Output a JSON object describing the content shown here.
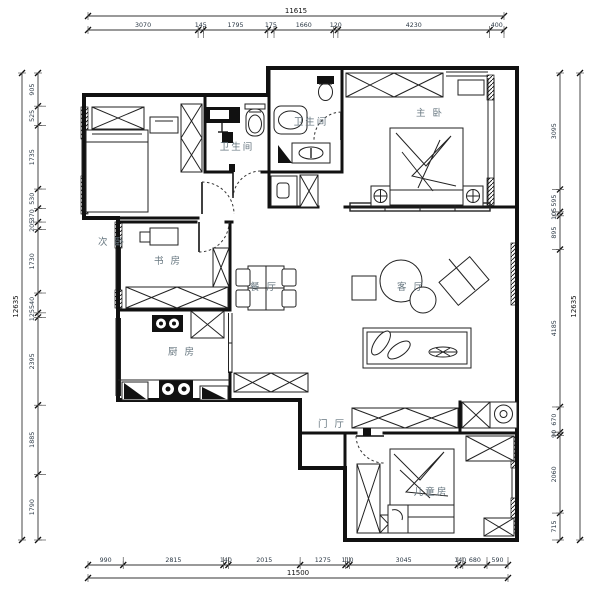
{
  "drawing_title": "apartment-floor-plan",
  "colors": {
    "wall": "#111111",
    "room_label": "#66767f",
    "dimension_text": "#2a3744",
    "background": "#ffffff"
  },
  "rooms": [
    {
      "id": "secondary-bedroom",
      "name": "次 卧",
      "x": 112,
      "y": 245
    },
    {
      "id": "bathroom-left",
      "name": "卫生间",
      "x": 237,
      "y": 150
    },
    {
      "id": "bathroom-master",
      "name": "卫生间",
      "x": 311,
      "y": 125
    },
    {
      "id": "master-bedroom",
      "name": "主 卧",
      "x": 430,
      "y": 116
    },
    {
      "id": "study",
      "name": "书 房",
      "x": 168,
      "y": 264
    },
    {
      "id": "dining-room",
      "name": "餐 厅",
      "x": 264,
      "y": 290
    },
    {
      "id": "living-room",
      "name": "客 厅",
      "x": 411,
      "y": 290
    },
    {
      "id": "kitchen",
      "name": "厨 房",
      "x": 182,
      "y": 355
    },
    {
      "id": "entry-hall",
      "name": "门 厅",
      "x": 332,
      "y": 427
    },
    {
      "id": "children-room",
      "name": "儿童房",
      "x": 431,
      "y": 495
    }
  ],
  "dimensions": {
    "top": {
      "total": "11615",
      "segments": [
        "3070",
        "145",
        "1795",
        "175",
        "1660",
        "120",
        "4230",
        "400"
      ]
    },
    "bottom": {
      "total": "11500",
      "segments": [
        "990",
        "2815",
        "140",
        "2015",
        "1275",
        "110",
        "3045",
        "140",
        "680",
        "590"
      ]
    },
    "left": {
      "total": "12635",
      "segments": [
        "905",
        "525",
        "1735",
        "530",
        "370",
        "205",
        "1730",
        "540",
        "125",
        "2395",
        "1885",
        "1790"
      ]
    },
    "right": {
      "total": "12635",
      "segments": [
        "3095",
        "595",
        "105",
        "895",
        "4185",
        "670",
        "90",
        "2060",
        "715"
      ]
    }
  }
}
